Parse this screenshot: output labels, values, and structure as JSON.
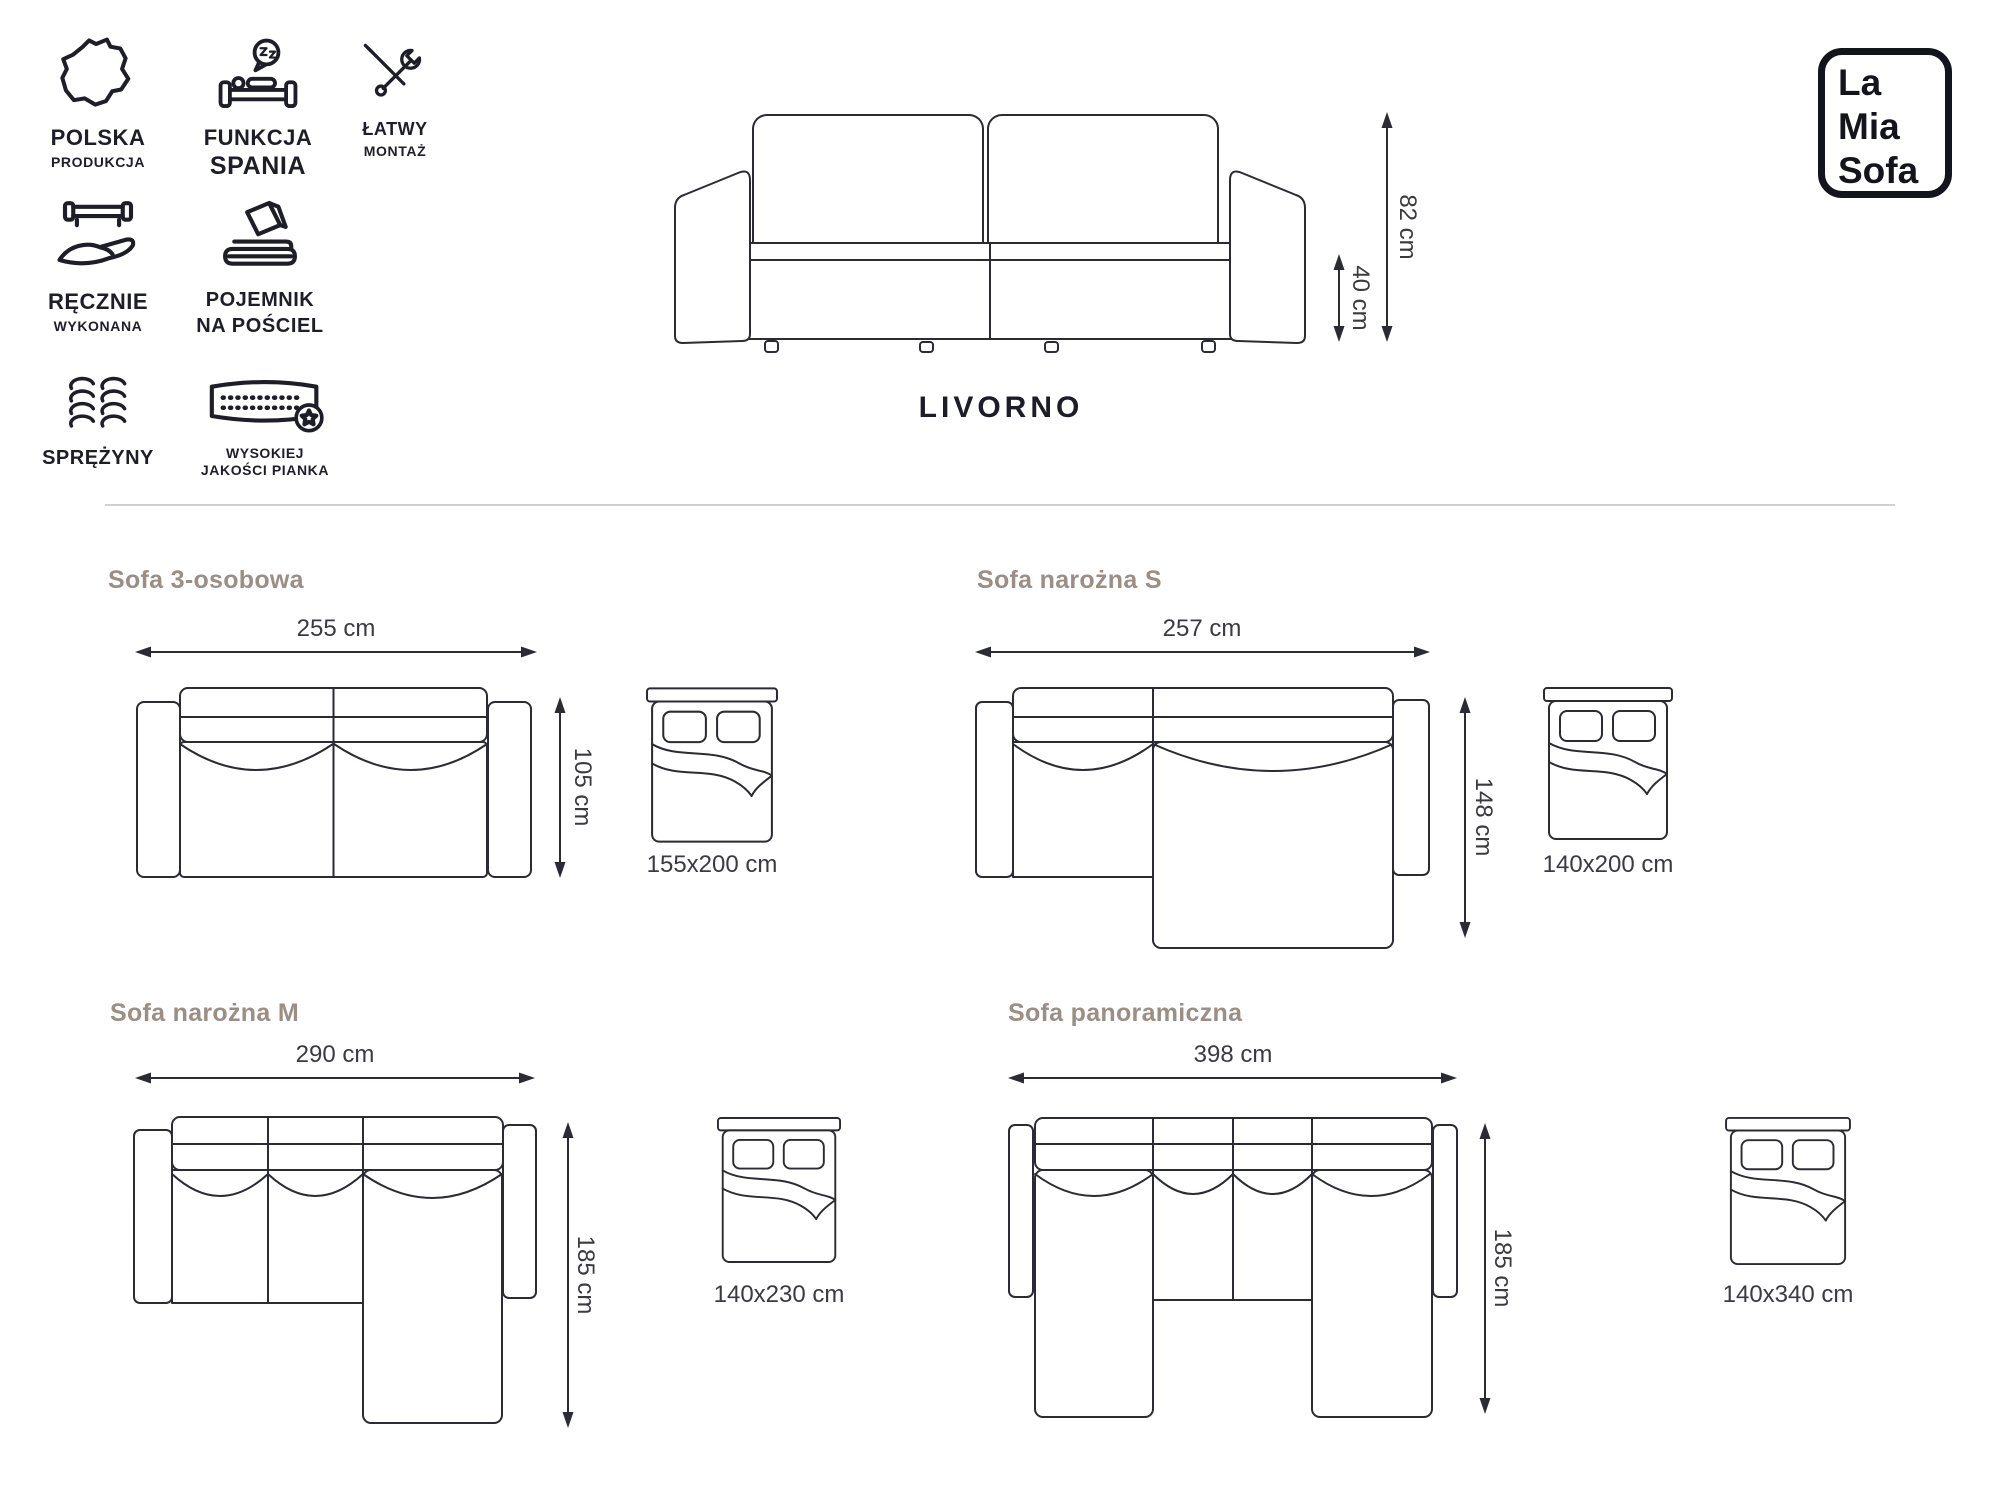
{
  "product": {
    "name": "LIVORNO",
    "height": "82 cm",
    "seat_height": "40 cm"
  },
  "logo": {
    "line1": "La",
    "line2": "Mia",
    "line3": "Sofa"
  },
  "features": [
    {
      "line1": "POLSKA",
      "line2": "PRODUKCJA"
    },
    {
      "line1": "FUNKCJA",
      "line2": "SPANIA"
    },
    {
      "line1": "ŁATWY",
      "line2": "MONTAŻ"
    },
    {
      "line1": "RĘCZNIE",
      "line2": "WYKONANA"
    },
    {
      "line1": "POJEMNIK",
      "line2": "NA POŚCIEL"
    },
    {
      "line1": "SPRĘŻYNY",
      "line2": ""
    },
    {
      "line1": "WYSOKIEJ",
      "line2": "JAKOŚCI PIANKA"
    }
  ],
  "variants": [
    {
      "name": "Sofa 3-osobowa",
      "width": "255 cm",
      "depth": "105 cm",
      "bed_size": "155x200 cm"
    },
    {
      "name": "Sofa narożna S",
      "width": "257 cm",
      "depth": "148 cm",
      "bed_size": "140x200 cm"
    },
    {
      "name": "Sofa narożna M",
      "width": "290 cm",
      "depth": "185 cm",
      "bed_size": "140x230 cm"
    },
    {
      "name": "Sofa panoramiczna",
      "width": "398 cm",
      "depth": "185 cm",
      "bed_size": "140x340 cm"
    }
  ],
  "colors": {
    "line": "#2b2b33",
    "heading": "#9b8e85",
    "dimension_text": "#3a3a40",
    "label_text": "#1e1e28",
    "divider": "#d0d0d0"
  }
}
